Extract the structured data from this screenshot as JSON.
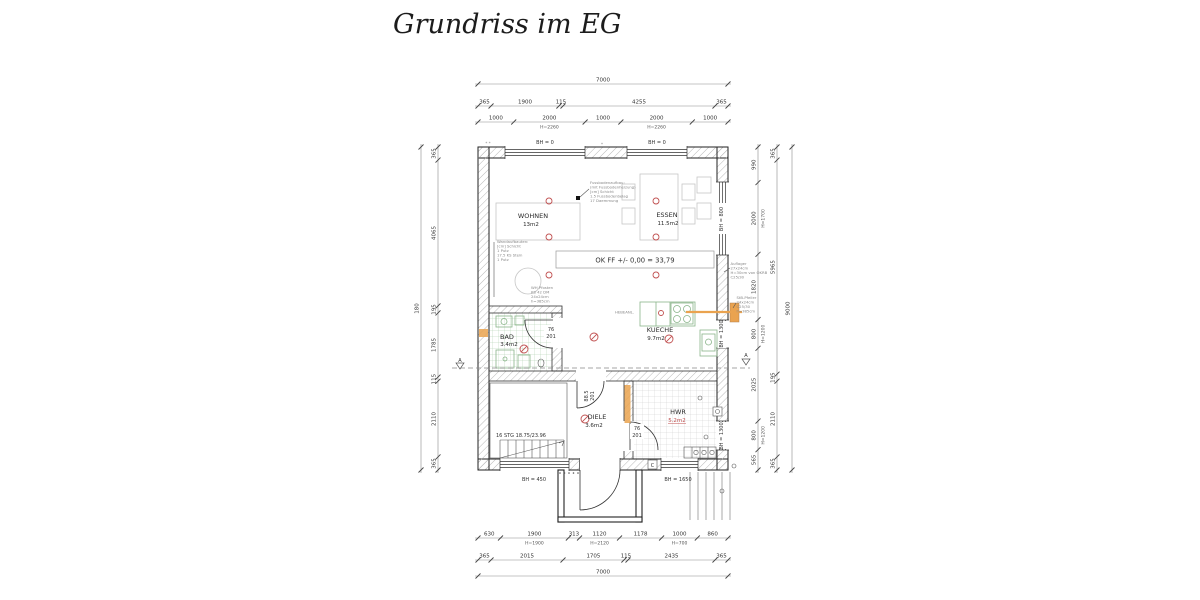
{
  "title": "Grundriss im EG",
  "rooms": {
    "wohnen": {
      "name": "WOHNEN",
      "area": "13m2"
    },
    "essen": {
      "name": "ESSEN",
      "area": "11.5m2"
    },
    "kueche": {
      "name": "KUECHE",
      "area": "9.7m2"
    },
    "bad": {
      "name": "BAD",
      "area": "3.4m2"
    },
    "diele": {
      "name": "DIELE",
      "area": "3.6m2"
    },
    "hwr": {
      "name": "HWR",
      "area": "5.2m2"
    }
  },
  "labels": {
    "bh0_a": "BH = 0",
    "bh0_b": "BH = 0",
    "bh800": "BH = 800",
    "bh1300_a": "BH = 1300",
    "bh1300_b": "BH = 1300",
    "bh450": "BH = 450",
    "bh1650": "BH = 1650",
    "level": "OK FF +/- 0,00 = 33,79",
    "stairs": "16 STG 18.75/23.96",
    "section_a": "A",
    "hebe": "HEBEANL.",
    "box_c": "C",
    "corner_marks": "* *",
    "mid_mark": "*"
  },
  "doors": {
    "bad": {
      "w": "76",
      "h": "201"
    },
    "diele": {
      "w": "88.5",
      "h": "201"
    },
    "hwr": {
      "w": "76",
      "h": "201"
    }
  },
  "notes": {
    "floor": [
      "Fussbodenaufbau:",
      "(mit Fussbodenheizung)",
      "[cm]  Schicht",
      "1.5  Fussbodenbelag",
      "17  Daemmung"
    ],
    "wall": [
      "Wandaufbauten:",
      "[cm]  Schicht",
      "1  Putz",
      "17.5  KS Stein",
      "1  Putz"
    ],
    "post": [
      "WH Pfosten",
      "KS 42 DM",
      "24x24cm",
      "h=385cm"
    ],
    "support": [
      "Auflager",
      "27x24cm",
      "H=30cm von OKRB",
      "C25/30"
    ],
    "column": [
      "StB-Pfeiler",
      "24x24cm",
      "C25/30",
      "h=385cm"
    ]
  },
  "dimensions": {
    "t1": [
      {
        "v": 7000
      }
    ],
    "t2": [
      {
        "v": 365
      },
      {
        "v": 1900
      },
      {
        "v": 115
      },
      {
        "v": 4255
      },
      {
        "v": 365
      }
    ],
    "t3": [
      {
        "v": 1000
      },
      {
        "v": 2000,
        "s": "H=2260"
      },
      {
        "v": 1000
      },
      {
        "v": 2000,
        "s": "H=2260"
      },
      {
        "v": 1000
      }
    ],
    "b1": [
      {
        "v": 630
      },
      {
        "v": 1900,
        "s": "H=1900"
      },
      {
        "v": 313
      },
      {
        "v": 1120,
        "s": "H=2120"
      },
      {
        "v": 1178
      },
      {
        "v": 1000,
        "s": "H=700"
      },
      {
        "v": 860
      }
    ],
    "b2": [
      {
        "v": 365
      },
      {
        "v": 2015
      },
      {
        "v": 1705
      },
      {
        "v": 115
      },
      {
        "v": 2435
      },
      {
        "v": 365
      }
    ],
    "b3": [
      {
        "v": 7000
      }
    ],
    "l1": [
      {
        "v": 365
      },
      {
        "v": 4065
      },
      {
        "v": 195
      },
      {
        "v": 1785
      },
      {
        "v": 115
      },
      {
        "v": 2110
      },
      {
        "v": 365
      }
    ],
    "l2": [
      {
        "v": 9000,
        "l": "180"
      }
    ],
    "r1": [
      {
        "v": 990
      },
      {
        "v": 2000,
        "s": "H=1700"
      },
      {
        "v": 1820
      },
      {
        "v": 800,
        "s": "H=1200"
      },
      {
        "v": 2025
      },
      {
        "v": 800,
        "s": "H=1200"
      },
      {
        "v": 565
      }
    ],
    "r2": [
      {
        "v": 365
      },
      {
        "v": 5965
      },
      {
        "v": 195
      },
      {
        "v": 2110
      },
      {
        "v": 365
      }
    ],
    "r3": [
      {
        "v": 9000
      }
    ]
  },
  "colors": {
    "accent_orange": "#eaa34f",
    "symbol_red": "#c05050",
    "fixture_green": "#8ab58a",
    "hatch_gray": "#b8b8b8"
  }
}
